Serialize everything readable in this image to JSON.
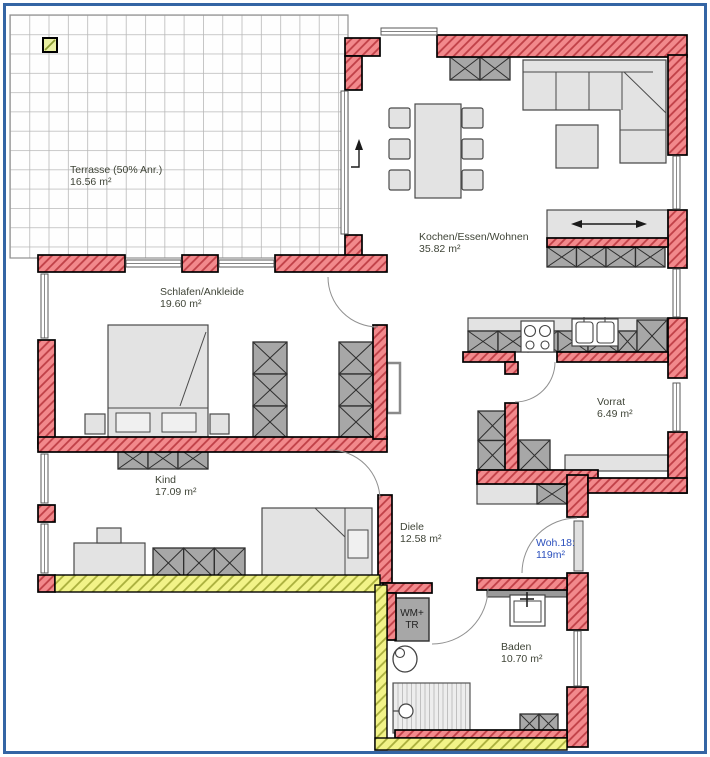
{
  "floorplan": {
    "rooms": {
      "terrasse": {
        "name": "Terrasse (50% Anr.)",
        "area": "16.56 m²"
      },
      "kochen": {
        "name": "Kochen/Essen/Wohnen",
        "area": "35.82 m²"
      },
      "schlafen": {
        "name": "Schlafen/Ankleide",
        "area": "19.60 m²"
      },
      "kind": {
        "name": "Kind",
        "area": "17.09 m²"
      },
      "diele": {
        "name": "Diele",
        "area": "12.58 m²"
      },
      "vorrat": {
        "name": "Vorrat",
        "area": "6.49 m²"
      },
      "baden": {
        "name": "Baden",
        "area": "10.70 m²"
      }
    },
    "unit": {
      "label": "Woh.18:",
      "area": "119m²"
    },
    "appliances": {
      "wm_tr_line1": "WM+",
      "wm_tr_line2": "TR"
    },
    "colors": {
      "wall_fill": "#f2898c",
      "wall_hatch": "#bf3f46",
      "wall_outline": "#000000",
      "insulation_fill": "#f2f388",
      "insulation_hatch": "#a9ae3c",
      "furniture_dark": "#a7a7a7",
      "furniture_light": "#e3e3e3",
      "terrace_grid": "#b8b8b8",
      "room_label": "#3f4437",
      "unit_label": "#2b50bd",
      "page_border": "#3465a4",
      "terrace_marker": "#e9f0a2"
    }
  }
}
